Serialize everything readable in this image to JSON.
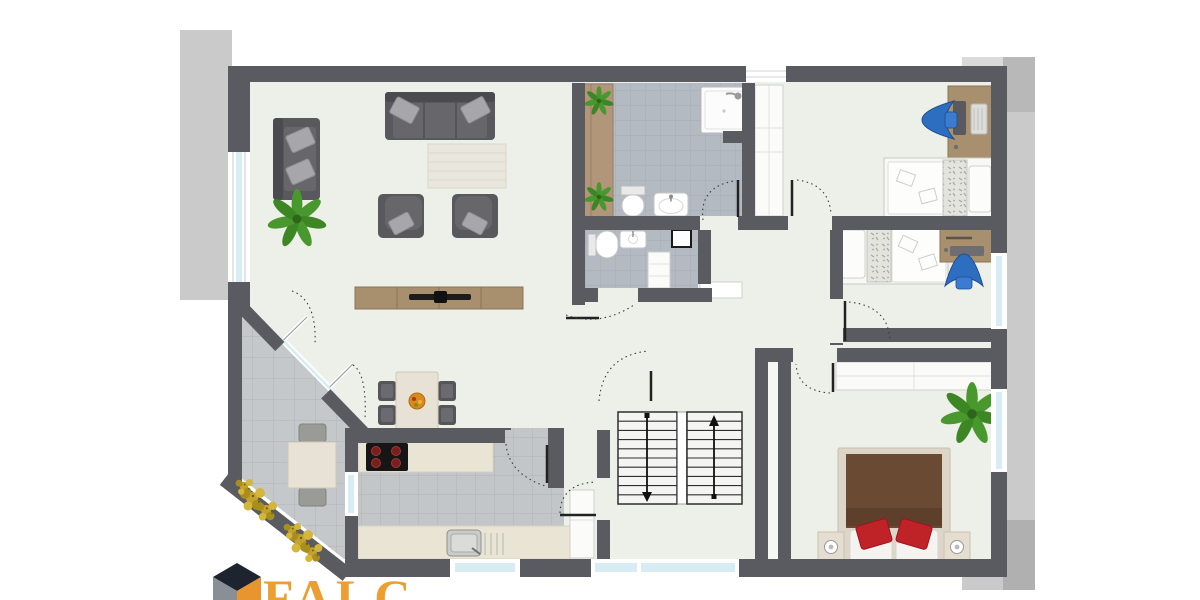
{
  "brand": {
    "name": "FALC",
    "fragment": "O B",
    "accent_orange": "#ED9E33",
    "cube_dark": "#1d2430",
    "cube_gray": "#8a8f96"
  },
  "plan": {
    "type": "apartment-floor-plan",
    "rooms": [
      {
        "name": "living-room"
      },
      {
        "name": "dining-area"
      },
      {
        "name": "kitchen"
      },
      {
        "name": "terrace"
      },
      {
        "name": "bathroom"
      },
      {
        "name": "wc"
      },
      {
        "name": "hallway"
      },
      {
        "name": "stairwell"
      },
      {
        "name": "children-bedroom-1"
      },
      {
        "name": "children-bedroom-2"
      },
      {
        "name": "master-bedroom"
      }
    ],
    "stairs": {
      "left_flight_direction": "down",
      "right_flight_direction": "up"
    },
    "colors": {
      "wall": "#5a5a61",
      "floor": "#edf0e8",
      "bath_tile": "#b3bac2",
      "terrace_tile": "#c5c8ca",
      "kitchen_tile": "#c2c6c9",
      "window_glass": "#d8ecf3",
      "shadow": "#969696",
      "wood": "#a8906f",
      "sofa": "#58585d",
      "bed_blanket_brown": "#6b4a33",
      "pillow_red": "#bf2328",
      "chair_blue": "#2e6ec1",
      "plant_green": "#49982e"
    }
  }
}
